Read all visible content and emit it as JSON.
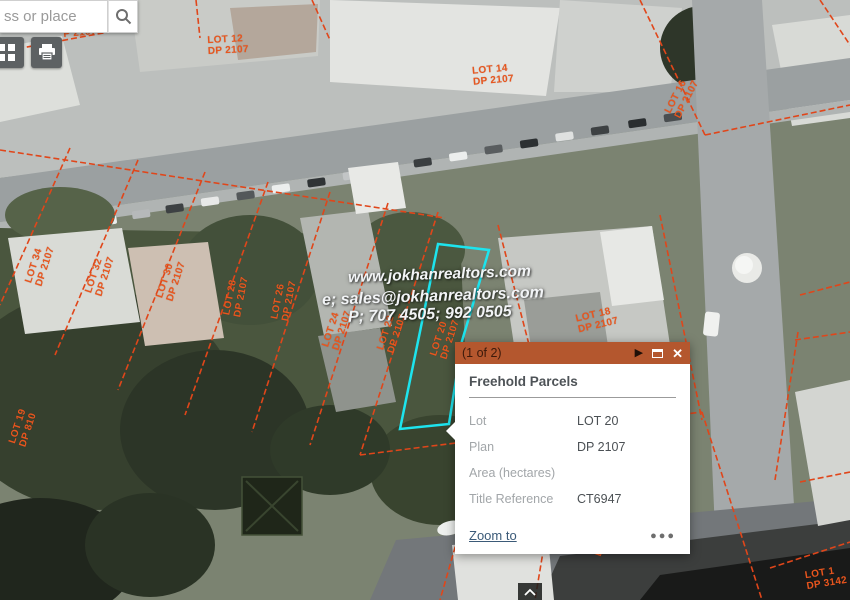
{
  "search": {
    "placeholder": "ss or place"
  },
  "watermark": {
    "line1": "www.jokhanrealtors.com",
    "line2": "e; sales@jokhanrealtors.com",
    "line3": "P; 707 4505; 992 0505"
  },
  "popup": {
    "pager": "(1 of 2)",
    "title": "Freehold Parcels",
    "fields": [
      {
        "label": "Lot",
        "value": "LOT 20"
      },
      {
        "label": "Plan",
        "value": "DP 2107"
      },
      {
        "label": "Area (hectares)",
        "value": ""
      },
      {
        "label": "Title Reference",
        "value": "CT6947"
      }
    ],
    "zoom_to_label": "Zoom to",
    "more_label": "●●●",
    "next_icon": "▶",
    "close_icon": "✕"
  },
  "parcels": [
    {
      "lot": "",
      "plan": "P 2107"
    },
    {
      "lot": "LOT 12",
      "plan": "DP 2107"
    },
    {
      "lot": "LOT 14",
      "plan": "DP 2107"
    },
    {
      "lot": "LOT 16",
      "plan": "DP 2107"
    },
    {
      "lot": "LOT 34",
      "plan": "DP 2107"
    },
    {
      "lot": "LOT 32",
      "plan": "DP 2107"
    },
    {
      "lot": "LOT 30",
      "plan": "DP 2107"
    },
    {
      "lot": "LOT 28",
      "plan": "DP 2107"
    },
    {
      "lot": "LOT 26",
      "plan": "DP 2107"
    },
    {
      "lot": "LOT 24",
      "plan": "DP 2107"
    },
    {
      "lot": "LOT 22",
      "plan": "DP 2107"
    },
    {
      "lot": "LOT 20",
      "plan": "DP 2107"
    },
    {
      "lot": "LOT 18",
      "plan": "DP 2107"
    },
    {
      "lot": "LOT 19",
      "plan": "DP 810"
    },
    {
      "lot": "LOT 1",
      "plan": "DP 8946"
    },
    {
      "lot": "LOT 1",
      "plan": "DP 8577"
    },
    {
      "lot": "LOT 1",
      "plan": "DP 3142"
    }
  ],
  "colors": {
    "accent_orange": "#b4572e",
    "parcel_line": "#e0461a",
    "parcel_label": "#e8561e",
    "highlight_cyan": "#1de4ee",
    "link_blue": "#3b5a78"
  }
}
